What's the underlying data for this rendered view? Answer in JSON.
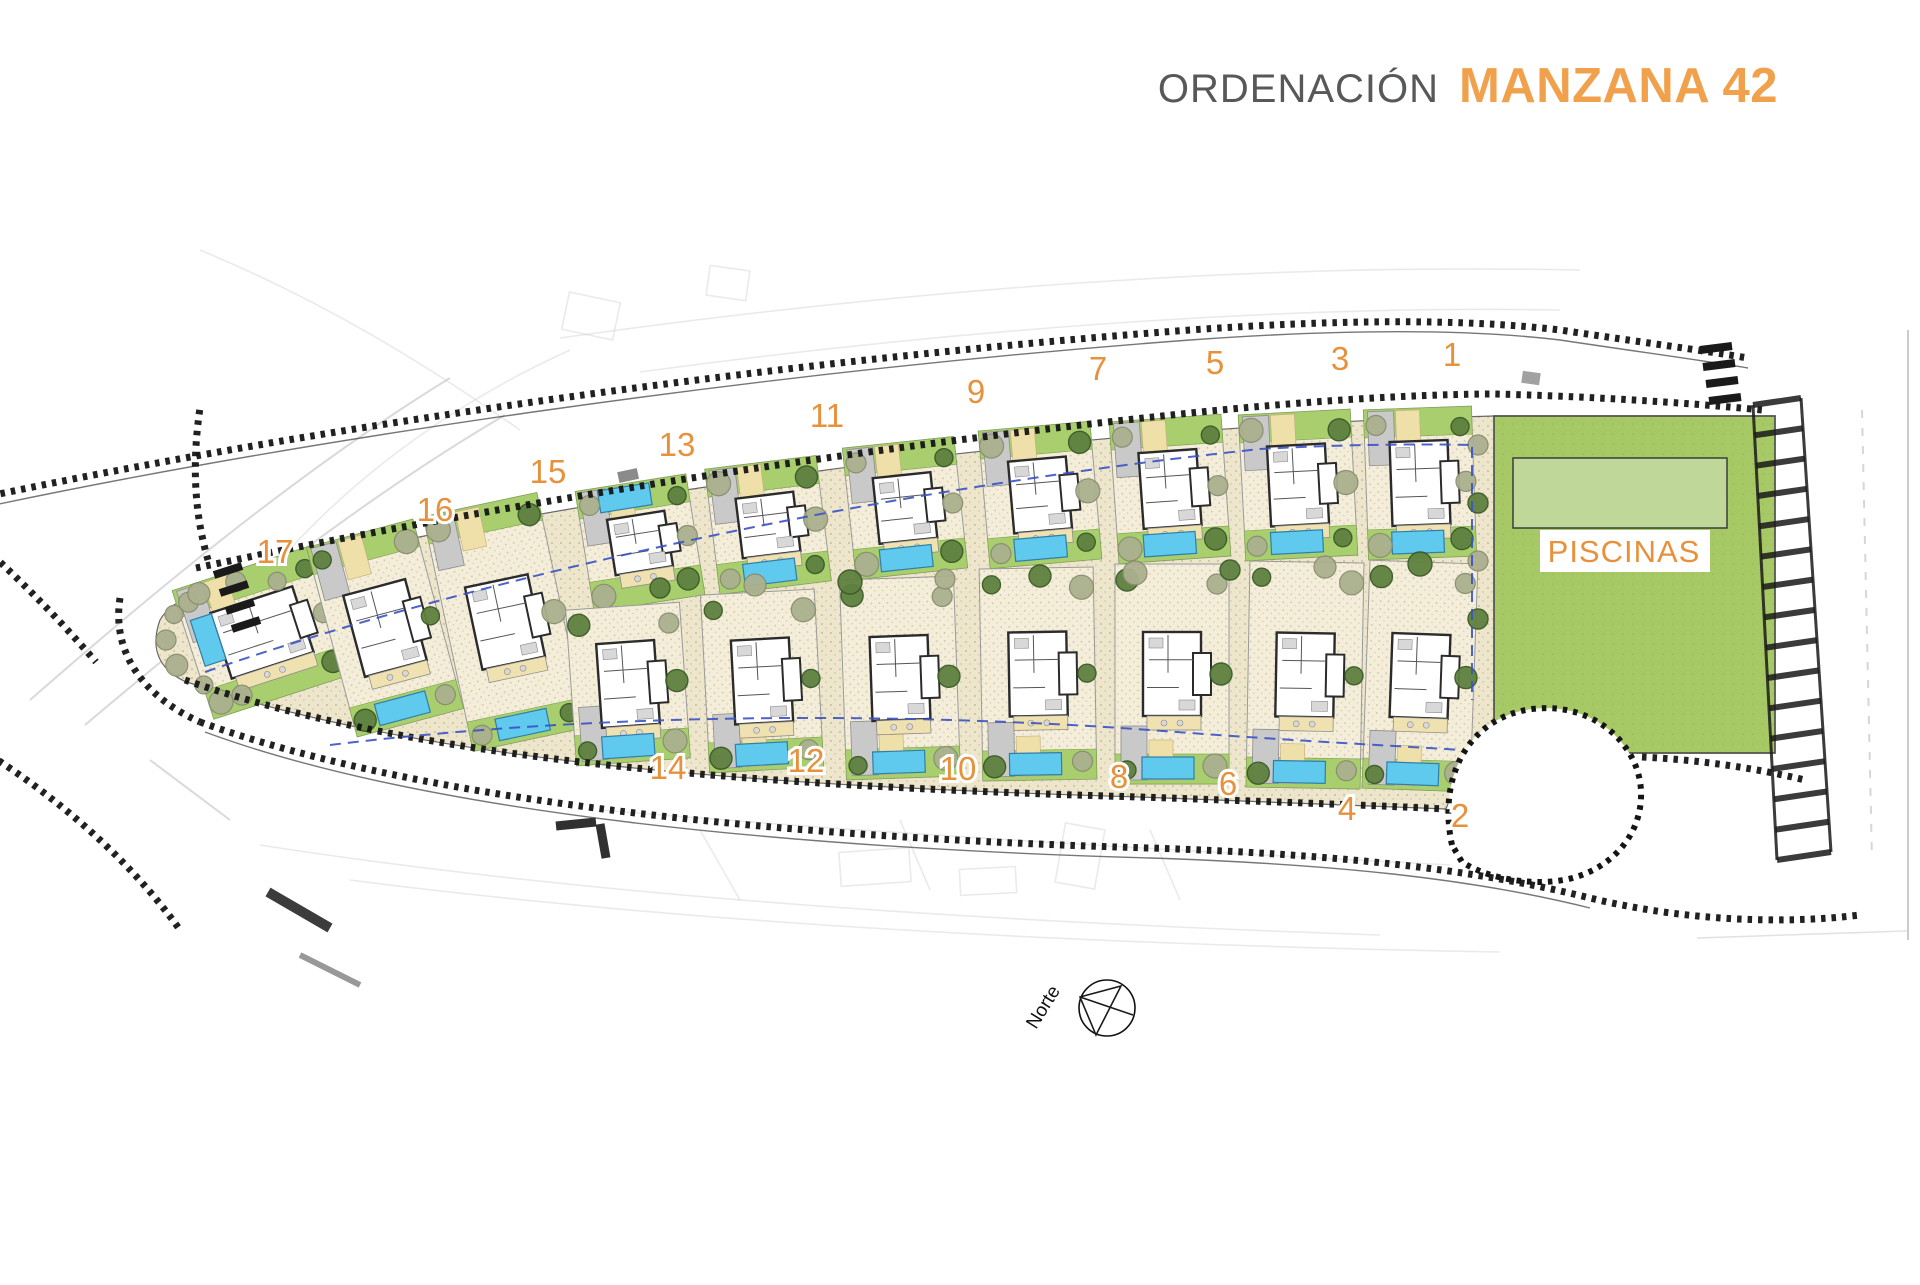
{
  "title": {
    "section": "ORDENACIÓN",
    "block": "MANZANA 42"
  },
  "legend": {
    "piscinas": "PISCINAS",
    "north": "Norte"
  },
  "plot_numbers": {
    "top": [
      {
        "n": "17",
        "x": 275,
        "y": 563
      },
      {
        "n": "16",
        "x": 435,
        "y": 521
      },
      {
        "n": "15",
        "x": 548,
        "y": 483
      },
      {
        "n": "13",
        "x": 677,
        "y": 456
      },
      {
        "n": "11",
        "x": 827,
        "y": 427
      },
      {
        "n": "9",
        "x": 976,
        "y": 403
      },
      {
        "n": "7",
        "x": 1098,
        "y": 380
      },
      {
        "n": "5",
        "x": 1215,
        "y": 374
      },
      {
        "n": "3",
        "x": 1340,
        "y": 370
      },
      {
        "n": "1",
        "x": 1452,
        "y": 366
      }
    ],
    "bottom": [
      {
        "n": "14",
        "x": 668,
        "y": 779
      },
      {
        "n": "12",
        "x": 806,
        "y": 772
      },
      {
        "n": "10",
        "x": 958,
        "y": 780
      },
      {
        "n": "8",
        "x": 1119,
        "y": 788
      },
      {
        "n": "6",
        "x": 1228,
        "y": 795
      },
      {
        "n": "4",
        "x": 1347,
        "y": 820
      },
      {
        "n": "2",
        "x": 1460,
        "y": 827
      }
    ]
  },
  "villas": [
    {
      "id": "17",
      "x": 262,
      "y": 565,
      "w": 145,
      "h": 135,
      "r": -18,
      "row": "tip",
      "pool": "left"
    },
    {
      "id": "16",
      "x": 385,
      "y": 530,
      "w": 110,
      "h": 196,
      "r": -15,
      "row": "full",
      "pool": "bottom"
    },
    {
      "id": "15",
      "x": 505,
      "y": 502,
      "w": 116,
      "h": 240,
      "r": -12,
      "row": "full",
      "pool": "bottom"
    },
    {
      "id": "13",
      "x": 640,
      "y": 482,
      "w": 112,
      "h": 122,
      "r": -9,
      "row": "top",
      "pool": "top"
    },
    {
      "id": "11",
      "x": 768,
      "y": 462,
      "w": 112,
      "h": 126,
      "r": -7,
      "row": "top",
      "pool": "bottom"
    },
    {
      "id": "9",
      "x": 905,
      "y": 442,
      "w": 112,
      "h": 132,
      "r": -6,
      "row": "top",
      "pool": "bottom"
    },
    {
      "id": "7",
      "x": 1040,
      "y": 426,
      "w": 112,
      "h": 138,
      "r": -5,
      "row": "top",
      "pool": "bottom"
    },
    {
      "id": "5",
      "x": 1170,
      "y": 418,
      "w": 112,
      "h": 142,
      "r": -4,
      "row": "top",
      "pool": "bottom"
    },
    {
      "id": "3",
      "x": 1298,
      "y": 412,
      "w": 112,
      "h": 146,
      "r": -3,
      "row": "top",
      "pool": "bottom"
    },
    {
      "id": "1",
      "x": 1420,
      "y": 408,
      "w": 108,
      "h": 150,
      "r": -2,
      "row": "top",
      "pool": "bottom"
    },
    {
      "id": "14",
      "x": 628,
      "y": 606,
      "w": 114,
      "h": 156,
      "r": -4,
      "row": "bottom",
      "pool": "bottom"
    },
    {
      "id": "12",
      "x": 762,
      "y": 592,
      "w": 114,
      "h": 178,
      "r": -3,
      "row": "bottom",
      "pool": "bottom"
    },
    {
      "id": "10",
      "x": 900,
      "y": 578,
      "w": 114,
      "h": 200,
      "r": -2,
      "row": "bottom",
      "pool": "bottom"
    },
    {
      "id": "8",
      "x": 1038,
      "y": 568,
      "w": 114,
      "h": 212,
      "r": -1,
      "row": "bottom",
      "pool": "bottom"
    },
    {
      "id": "6",
      "x": 1172,
      "y": 564,
      "w": 114,
      "h": 220,
      "r": 0,
      "row": "bottom",
      "pool": "bottom"
    },
    {
      "id": "4",
      "x": 1305,
      "y": 562,
      "w": 114,
      "h": 226,
      "r": 1,
      "row": "bottom",
      "pool": "bottom"
    },
    {
      "id": "2",
      "x": 1420,
      "y": 562,
      "w": 108,
      "h": 228,
      "r": 2,
      "row": "bottom",
      "pool": "bottom"
    }
  ],
  "piscinas_area": {
    "x": 1494,
    "y": 416,
    "w": 281,
    "h": 337,
    "pool": {
      "x": 1513,
      "y": 458,
      "w": 214,
      "h": 70
    }
  },
  "compass": {
    "cx": 1107,
    "cy": 1008,
    "r": 28
  },
  "colors": {
    "orange": "#E8913C",
    "orangeTitle": "#F1A14C",
    "grayTitle": "#57585A",
    "sand": "#EDE6CC",
    "sandLight": "#F3EDDA",
    "dot": "#CFC49E",
    "gardenGreen": "#A8CE6E",
    "piscGreen": "#A6C965",
    "poolZone": "#BFD89A",
    "pool": "#5FC9EE",
    "poolStroke": "#2F7FA8",
    "treeDark": "#5E8140",
    "treeDarkStroke": "#3A5A26",
    "treeOlive": "#ABB08F",
    "treeOliveStroke": "#888D6E",
    "wall": "#2B2B2B",
    "garage": "#C9C9C9",
    "drive": "#EFDFA8",
    "terrace": "#F0E2B0",
    "roadInk": "#141414",
    "blue": "#3A52C4"
  }
}
